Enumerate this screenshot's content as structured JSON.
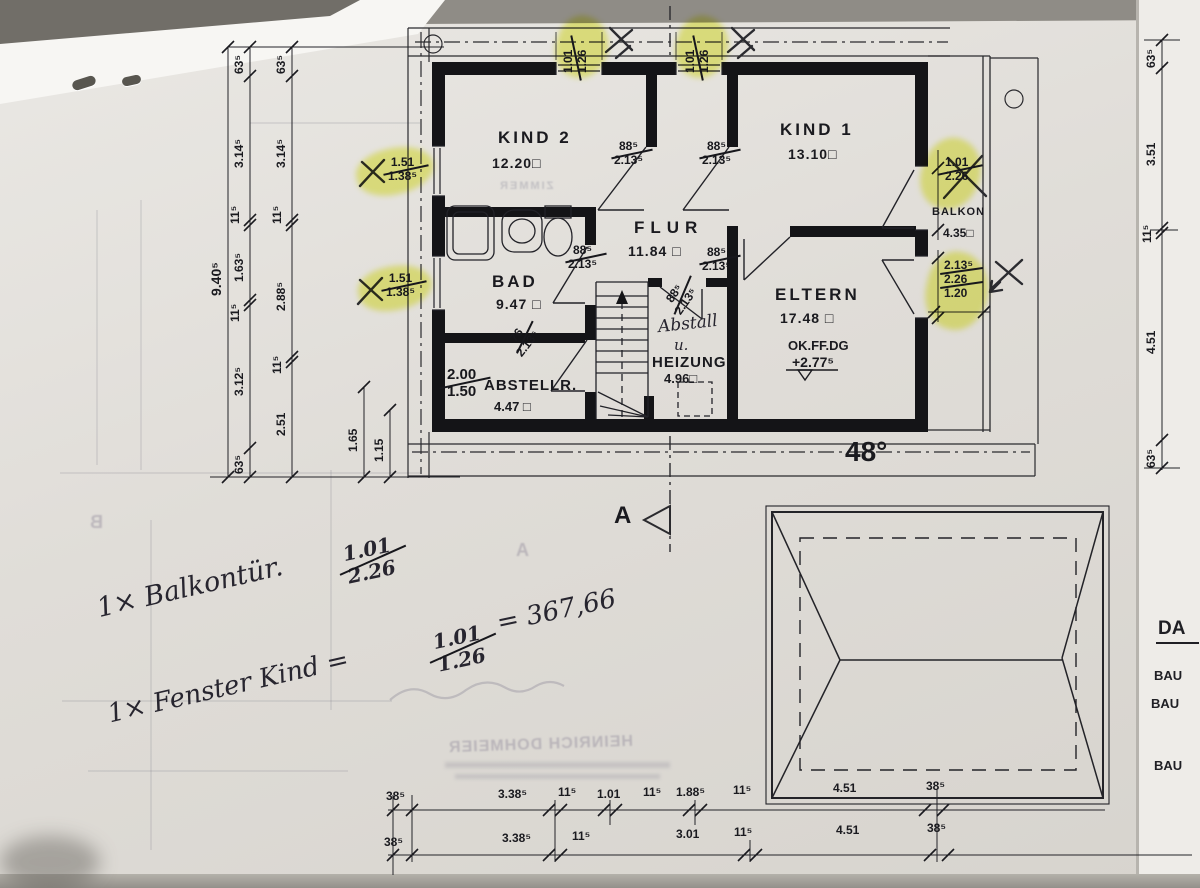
{
  "rooms": {
    "kind2_name": "KIND 2",
    "kind2_area": "12.20□",
    "kind1_name": "KIND 1",
    "kind1_area": "13.10□",
    "flur_name": "FLUR",
    "flur_area": "11.84 □",
    "bad_name": "BAD",
    "bad_area": "9.47 □",
    "abstell_name": "ABSTELLR.",
    "abstell_area": "4.47 □",
    "abstell_frac_top": "2.00",
    "abstell_frac_bottom": "1.50",
    "heizung_hand1": "Abstall",
    "heizung_hand2": "u.",
    "heizung_name": "HEIZUNG",
    "heizung_area": "4.96□",
    "eltern_name": "ELTERN",
    "eltern_area": "17.48 □",
    "balkon_name": "BALKON",
    "balkon_area": "4.35□"
  },
  "levels": {
    "label": "OK.FF.DG",
    "value": "+2.77⁵"
  },
  "doors": {
    "kind2_w": "88⁵",
    "kind2_h": "2.13⁵",
    "kind1_w": "88⁵",
    "kind1_h": "2.13⁵",
    "eltern_w": "88⁵",
    "eltern_h": "2.13⁵",
    "bad_w": "88⁵",
    "bad_h": "2.13⁵",
    "heizung_w": "88⁵",
    "heizung_h": "2.13⁵",
    "abstell_w": "76",
    "abstell_h": "2.13⁵"
  },
  "windows": {
    "top1_w": "1.01",
    "top1_h": "1.26",
    "top2_w": "1.01",
    "top2_h": "1.26",
    "left1_w": "1.51",
    "left1_h": "1.38⁵",
    "left2_w": "1.51",
    "left2_h": "1.38⁵",
    "right1_w": "1.01",
    "right1_h": "2.26",
    "right2_a": "2.13⁵",
    "right2_b": "2.26",
    "right2_c": "1.20"
  },
  "dims": {
    "left_outer": "9.40⁵",
    "left_col1": [
      "63⁵",
      "3.14⁵",
      "11⁵",
      "1.63⁵",
      "11⁵",
      "3.12⁵",
      "63⁵"
    ],
    "left_col2": [
      "63⁵",
      "3.14⁵",
      "11⁵",
      "2.88⁵",
      "11⁵",
      "2.51"
    ],
    "left_inner": [
      "1.65",
      "1.15"
    ],
    "right_col": [
      "63⁵",
      "3.51",
      "11⁵",
      "4.51",
      "63⁵"
    ],
    "bottom_row1": [
      "38⁵",
      "3.38⁵",
      "11⁵",
      "1.01",
      "11⁵",
      "1.88⁵",
      "11⁵",
      "4.51",
      "38⁵"
    ],
    "bottom_row2": [
      "38⁵",
      "3.38⁵",
      "11⁵",
      "3.01",
      "11⁵",
      "4.51",
      "38⁵"
    ]
  },
  "roof_angle": "48°",
  "section_label": "A",
  "notes": {
    "line1_prefix": "1× Balkontür.",
    "line1_frac_top": "1.01",
    "line1_frac_bottom": "2.26",
    "line2_prefix": "1× Fenster Kind =",
    "line2_frac_top": "1.01",
    "line2_frac_bottom": "1.26",
    "line2_result": "= 367,66"
  },
  "margin": {
    "da": "DA",
    "bau1": "BAU",
    "bau2": "BAU",
    "bau3": "BAU"
  },
  "bleed": {
    "stamp": "HEINRICH DOHMEIER",
    "marker_b": "B",
    "marker_a": "A",
    "zimmer": "ZIMMER"
  }
}
